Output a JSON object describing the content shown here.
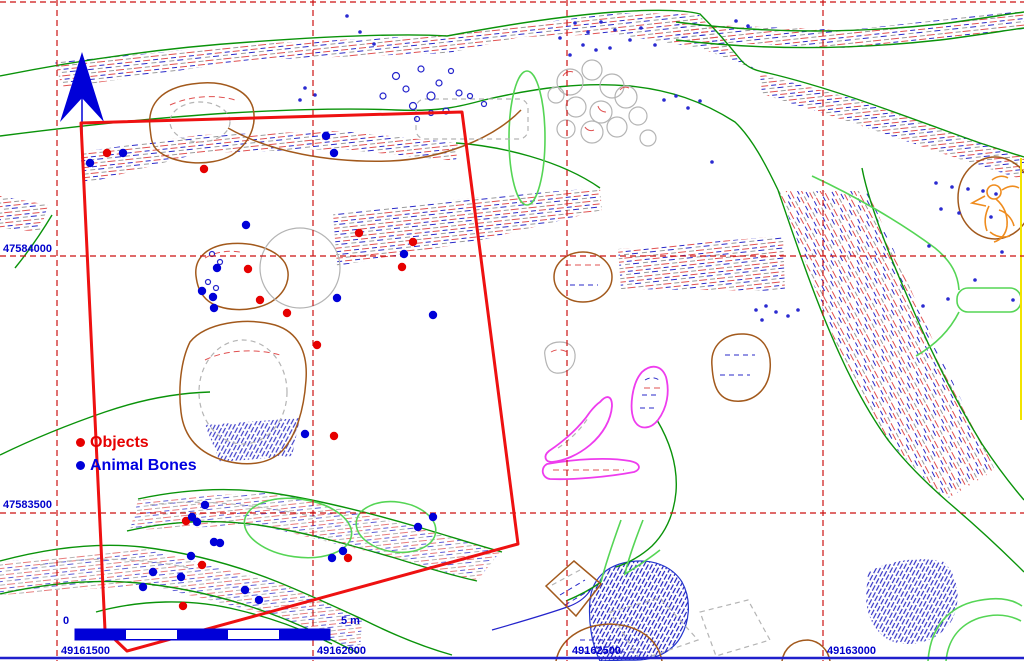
{
  "map": {
    "background": "#ffffff",
    "legend": {
      "objects_label": "Objects",
      "animal_bones_label": "Animal Bones",
      "objects_color": "#e60000",
      "animal_bones_color": "#0000d8"
    },
    "grid": {
      "line_color": "#cc1111",
      "label_color": "#0000cc",
      "x_label_y": 654,
      "top_line_y": 2,
      "x_ticks": [
        {
          "label": "49161500",
          "x": 57,
          "label_x": 61
        },
        {
          "label": "49162000",
          "x": 313,
          "label_x": 317
        },
        {
          "label": "49162500",
          "x": 567,
          "label_x": 572
        },
        {
          "label": "49163000",
          "x": 823,
          "label_x": 827
        }
      ],
      "y_ticks": [
        {
          "label": "47584000",
          "y": 256,
          "label_y": 252
        },
        {
          "label": "47583500",
          "y": 513,
          "label_y": 508
        }
      ]
    },
    "scalebar": {
      "x": 75,
      "y": 629,
      "width": 255,
      "height": 11,
      "segments": 5,
      "zero_label": "0",
      "end_label": "5 m",
      "color": "#0000d8"
    },
    "survey_area_color": "#ee1111",
    "survey_area": [
      [
        81,
        123
      ],
      [
        462,
        112
      ],
      [
        518,
        544
      ],
      [
        127,
        651
      ],
      [
        105,
        630
      ]
    ],
    "points": {
      "objects": [
        [
          107,
          153
        ],
        [
          204,
          169
        ],
        [
          248,
          269
        ],
        [
          260,
          300
        ],
        [
          287,
          313
        ],
        [
          359,
          233
        ],
        [
          413,
          242
        ],
        [
          402,
          267
        ],
        [
          317,
          345
        ],
        [
          334,
          436
        ],
        [
          186,
          521
        ],
        [
          348,
          558
        ],
        [
          202,
          565
        ],
        [
          183,
          606
        ]
      ],
      "animal_bones": [
        [
          90,
          163
        ],
        [
          123,
          153
        ],
        [
          326,
          136
        ],
        [
          334,
          153
        ],
        [
          246,
          225
        ],
        [
          217,
          268
        ],
        [
          202,
          291
        ],
        [
          213,
          297
        ],
        [
          214,
          308
        ],
        [
          337,
          298
        ],
        [
          404,
          254
        ],
        [
          433,
          315
        ],
        [
          305,
          434
        ],
        [
          205,
          505
        ],
        [
          192,
          517
        ],
        [
          197,
          522
        ],
        [
          214,
          542
        ],
        [
          220,
          543
        ],
        [
          191,
          556
        ],
        [
          153,
          572
        ],
        [
          181,
          577
        ],
        [
          143,
          587
        ],
        [
          245,
          590
        ],
        [
          259,
          600
        ],
        [
          343,
          551
        ],
        [
          332,
          558
        ],
        [
          433,
          517
        ],
        [
          418,
          527
        ]
      ]
    }
  }
}
